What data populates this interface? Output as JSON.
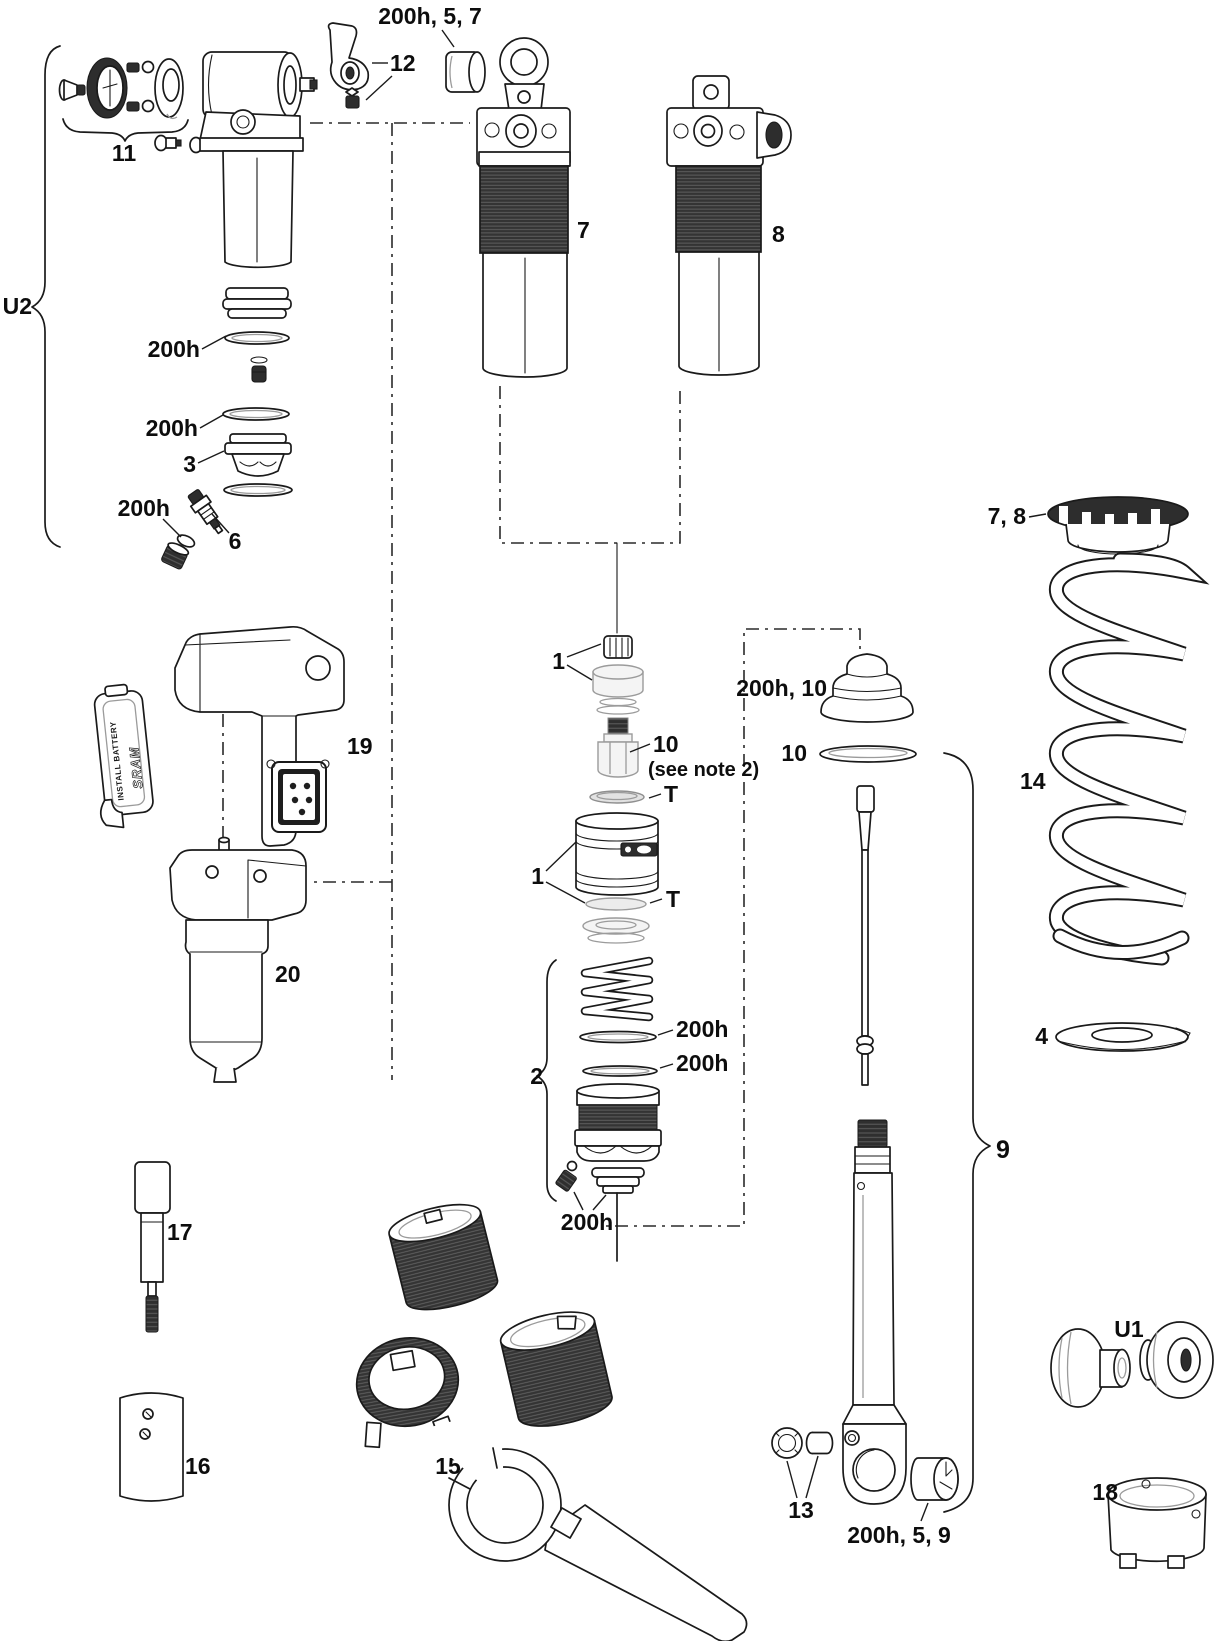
{
  "diagram": {
    "type": "exploded-parts-diagram",
    "background": "#ffffff",
    "ink": "#1a1a1a",
    "dark_fill": "#2d2d2d",
    "callouts": {
      "u2": "U2",
      "kit11": "11",
      "lever12": "12",
      "top_bushing": "200h, 5, 7",
      "seal_a": "200h",
      "seal_b": "200h",
      "part3": "3",
      "seal_c": "200h",
      "part6": "6",
      "part7": "7",
      "part8": "8",
      "part1a": "1",
      "part10_mid": "10",
      "note10": "(see note 2)",
      "t1": "T",
      "part1b": "1",
      "t2": "T",
      "part2": "2",
      "oring_a": "200h",
      "oring_b": "200h",
      "bottom_seal": "200h",
      "bumper": "200h, 10",
      "wiper10": "10",
      "preload": "7, 8",
      "spring14": "14",
      "plate4": "4",
      "brace9": "9",
      "part13": "13",
      "bushing959": "200h, 5, 9",
      "u1": "U1",
      "part18": "18",
      "part19": "19",
      "part20": "20",
      "part17": "17",
      "part16": "16",
      "part15": "15"
    },
    "battery": {
      "install": "INSTALL BATTERY",
      "brand": "SRAM"
    }
  }
}
